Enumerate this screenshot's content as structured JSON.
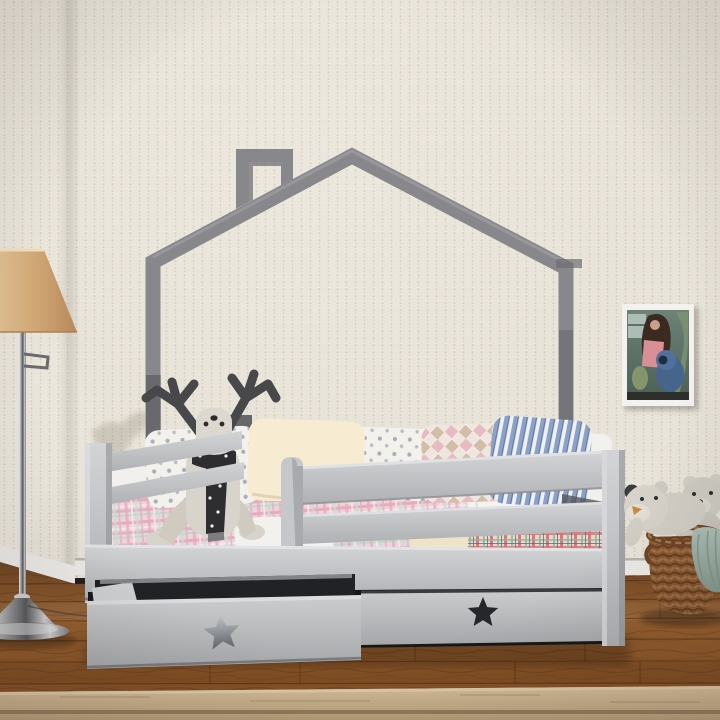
{
  "scene": {
    "label": "photo of a children's room with a gray house-frame bed, storage drawers, reindeer plush, floor lamp, wall art, teddy bears and wicker basket",
    "width_px": 720,
    "height_px": 720
  },
  "palette": {
    "wall": "#e9e4d9",
    "wall_dot": "#cfc3b0",
    "baseboard": "#ecebe7",
    "frame_gray": "#87878c",
    "frame_edge": "#9b9ba1",
    "frame_dark": "#6d6d72",
    "rail_dark": "#5d5e62",
    "bed_light": "#cbccce",
    "bed_mid": "#b4b5b9",
    "mattress": "#f1f0ed",
    "duvet": "#f4f3f0",
    "sheet_cream": "#efe3c8",
    "pillow_cream_hi": "#f7ecd2",
    "star_dark": "#25272a",
    "deer": "#d8d4cb",
    "antler": "#48484b",
    "scarf": "#2e2e31",
    "lamp_shade_mid": "#d3ab79",
    "chrome_mid": "#9fa0a3",
    "cord": "#3a3a3a",
    "floor_mid": "#8a5427",
    "plank_line": "#3f2713",
    "rug_seam": "#8b7254",
    "photo_frame": "#f4f2ee",
    "photo_pink": "#d98f96",
    "photo_blue": "#46648c",
    "photo_hair": "#3a2a22",
    "bear": "#d3cfc6",
    "bear_ear_dark": "#3c3c3e",
    "bear_nose_tan": "#c98a3f",
    "basket_dark": "#6f4526",
    "blanket_teal_line": "#7e948a"
  },
  "objects": [
    {
      "id": "house-frame-bed",
      "label": "gray house-shaped bed frame with chimney"
    },
    {
      "id": "storage-drawer-open",
      "label": "pulled-out under-bed drawer with star cutout"
    },
    {
      "id": "storage-drawer-closed",
      "label": "closed under-bed drawer with star cutout"
    },
    {
      "id": "reindeer-plush",
      "label": "knitted reindeer toy with black dotted scarf"
    },
    {
      "id": "pillows",
      "label": "row of polka-dot, cream, argyle and blue striped pillows"
    },
    {
      "id": "plaid-blanket",
      "label": "pink plaid blanket"
    },
    {
      "id": "floor-lamp",
      "label": "chrome swing-arm floor lamp with tan shade"
    },
    {
      "id": "wall-art",
      "label": "framed photo of a girl with a blue plush toy"
    },
    {
      "id": "teddy-bears",
      "label": "two gray teddy bears"
    },
    {
      "id": "wicker-basket",
      "label": "wicker basket with teal blanket"
    },
    {
      "id": "rug",
      "label": "beige rug on wooden floor"
    }
  ]
}
